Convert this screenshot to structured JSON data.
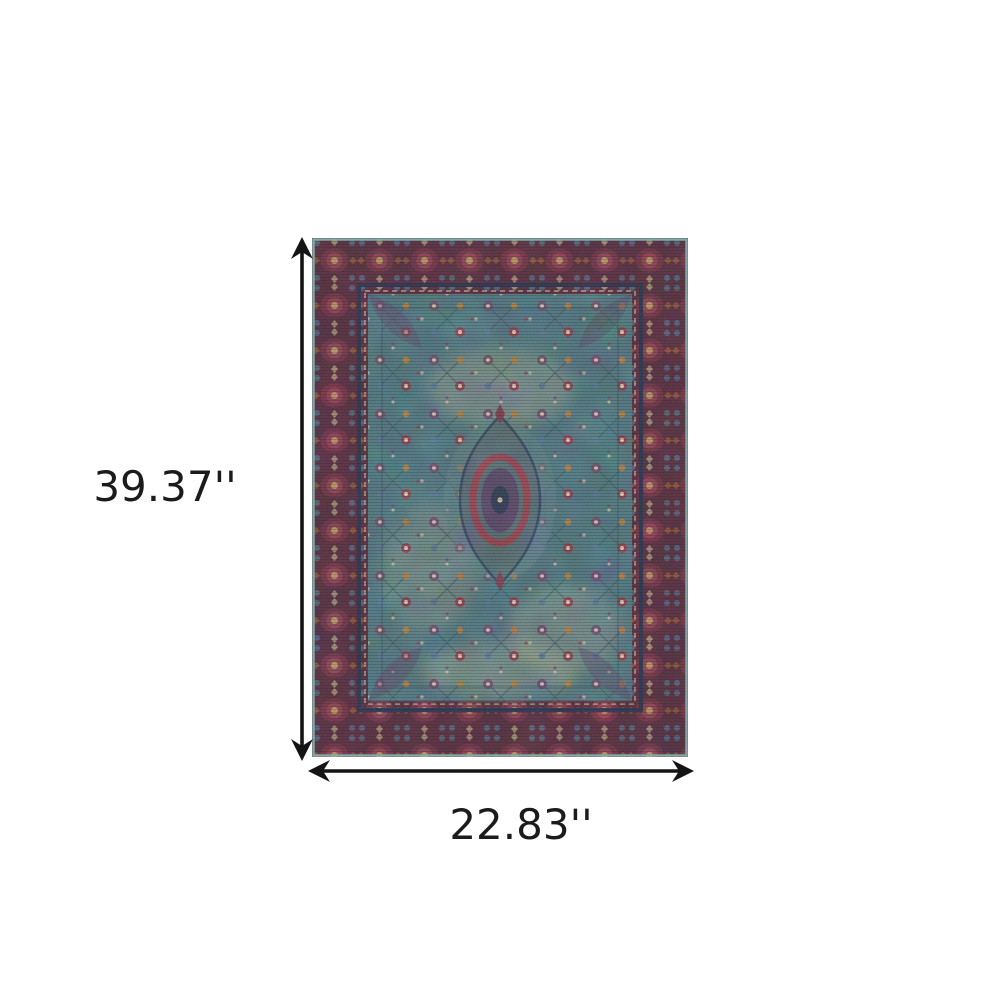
{
  "figure": {
    "type": "product-dimension-diagram",
    "height_label": "39.37''",
    "width_label": "22.83''"
  },
  "style": {
    "background": "#ffffff",
    "dimension_line_color": "#141414",
    "dimension_text_color": "#1b1b1b",
    "rug_palette": {
      "outer_edge": "#84adaa",
      "border_ground": "#542a3b",
      "rosette_red": "#8e4050",
      "rosette_gold": "#c59a5e",
      "guard_navy": "#27304a",
      "guard_beige": "#b6ac8e",
      "field_teal": "#4d737b",
      "floral_purple": "#5c4668",
      "floral_red": "#8a3d4d",
      "floral_orange": "#b3793a",
      "faded_beige": "#bfb394",
      "medallion_ring": "#95414d",
      "medallion_core": "#2e3a54"
    }
  }
}
